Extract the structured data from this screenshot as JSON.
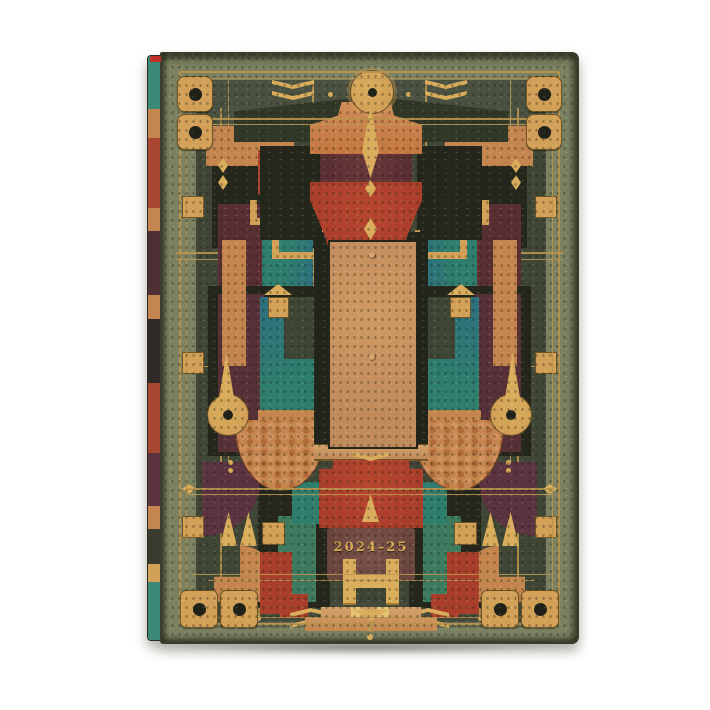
{
  "cover": {
    "year_label": "2024–25"
  },
  "colors": {
    "bg": "#ffffff",
    "sage": "#7b8161",
    "sagedark": "#4b5140",
    "panel": "#3f4635",
    "dark": "#25271d",
    "ink": "#20221a",
    "tan": "#c08a5a",
    "orange": "#c5854f",
    "orange2": "#c4763f",
    "gold": "#d2a057",
    "gold2": "#d9ad5c",
    "goldline": "#b8944e",
    "red": "#a93e2b",
    "maroon": "#5a2f33",
    "plum": "#583138",
    "wine": "#5c3340",
    "brown": "#6b463e",
    "teal": "#2e7d6d",
    "green": "#3e7a5f",
    "yeartext": "#dcae57"
  },
  "spine": {
    "segments": [
      {
        "c": "#3a8a77",
        "h": 9
      },
      {
        "c": "#c5854f",
        "h": 5
      },
      {
        "c": "#a84832",
        "h": 12
      },
      {
        "c": "#c5854f",
        "h": 4
      },
      {
        "c": "#4e2f35",
        "h": 11
      },
      {
        "c": "#c5854f",
        "h": 4
      },
      {
        "c": "#2f2a26",
        "h": 11
      },
      {
        "c": "#a84832",
        "h": 12
      },
      {
        "c": "#5c3340",
        "h": 9
      },
      {
        "c": "#c5854f",
        "h": 4
      },
      {
        "c": "#3a3b2e",
        "h": 6
      },
      {
        "c": "#d2a057",
        "h": 3
      },
      {
        "c": "#3a8a77",
        "h": 10
      }
    ]
  }
}
